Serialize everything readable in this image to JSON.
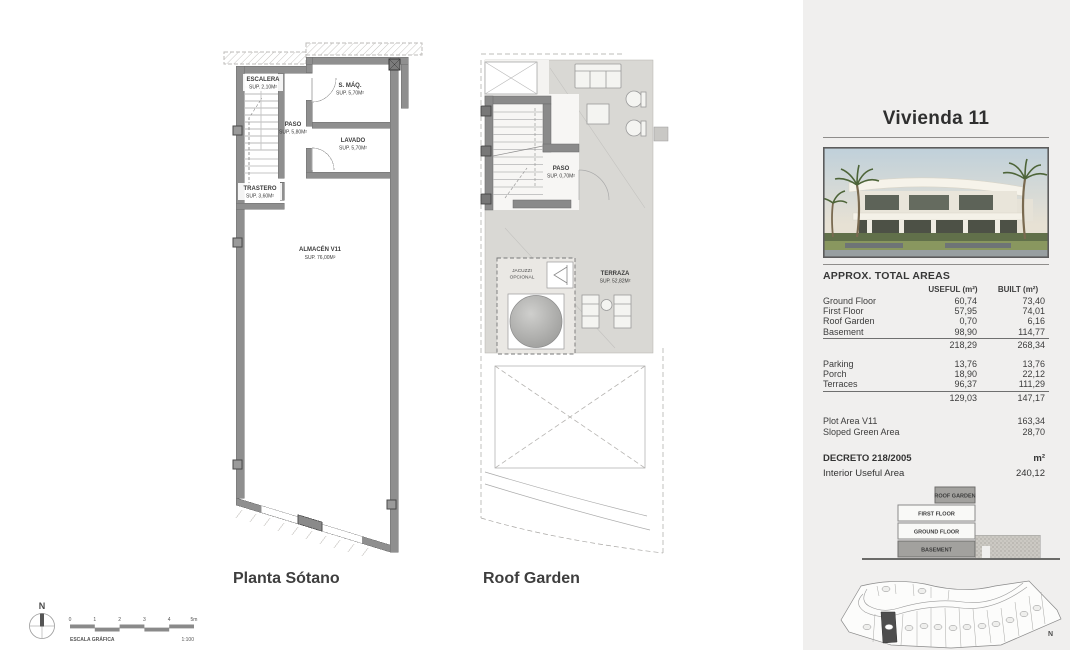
{
  "panel": {
    "title": "Vivienda 11",
    "areas": {
      "heading": "APPROX. TOTAL AREAS",
      "col_useful": "USEFUL (m²)",
      "col_built": "BUILT (m²)",
      "rows": [
        {
          "label": "Ground Floor",
          "useful": "60,74",
          "built": "73,40"
        },
        {
          "label": "First Floor",
          "useful": "57,95",
          "built": "74,01"
        },
        {
          "label": "Roof Garden",
          "useful": "0,70",
          "built": "6,16"
        },
        {
          "label": "Basement",
          "useful": "98,90",
          "built": "114,77"
        }
      ],
      "total1": {
        "useful": "218,29",
        "built": "268,34"
      },
      "rows2": [
        {
          "label": "Parking",
          "useful": "13,76",
          "built": "13,76"
        },
        {
          "label": "Porch",
          "useful": "18,90",
          "built": "22,12"
        },
        {
          "label": "Terraces",
          "useful": "96,37",
          "built": "111,29"
        }
      ],
      "total2": {
        "useful": "129,03",
        "built": "147,17"
      },
      "plot_area": {
        "label": "Plot Area V11",
        "value": "163,34"
      },
      "green_area": {
        "label": "Sloped Green Area",
        "value": "28,70"
      },
      "decreto": {
        "label": "DECRETO 218/2005",
        "unit": "m²"
      },
      "interior": {
        "label": "Interior Useful Area",
        "value": "240,12"
      }
    },
    "stack": {
      "roof": "ROOF GARDEN",
      "first": "FIRST FLOOR",
      "ground": "GROUND FLOOR",
      "basement": "BASEMENT"
    },
    "siteplan": {
      "north": "N"
    }
  },
  "plans": {
    "basement": {
      "title": "Planta Sótano",
      "escalera": {
        "name": "ESCALERA",
        "sup": "SUP. 2,10M²"
      },
      "smaq": {
        "name": "S. MÁQ.",
        "sup": "SUP. 5,70M²"
      },
      "paso": {
        "name": "PASO",
        "sup": "SUP. 5,80M²"
      },
      "lavado": {
        "name": "LAVADO",
        "sup": "SUP. 5,70M²"
      },
      "trastero": {
        "name": "TRASTERO",
        "sup": "SUP. 3,60M²"
      },
      "almacen": {
        "name": "ALMACÉN V11",
        "sup": "SUP. 76,00M²"
      }
    },
    "roof": {
      "title": "Roof Garden",
      "paso": {
        "name": "PASO",
        "sup": "SUP. 0,70M²"
      },
      "terraza": {
        "name": "TERRAZA",
        "sup": "SUP. 52,82M²"
      },
      "jacuzzi": {
        "line1": "JACUZZI",
        "line2": "OPCIONAL"
      }
    }
  },
  "scalebar": {
    "north": "N",
    "ticks": [
      "0",
      "1",
      "2",
      "3",
      "4",
      "5m"
    ],
    "label": "ESCALA GRÁFICA",
    "ratio": "1:100"
  }
}
